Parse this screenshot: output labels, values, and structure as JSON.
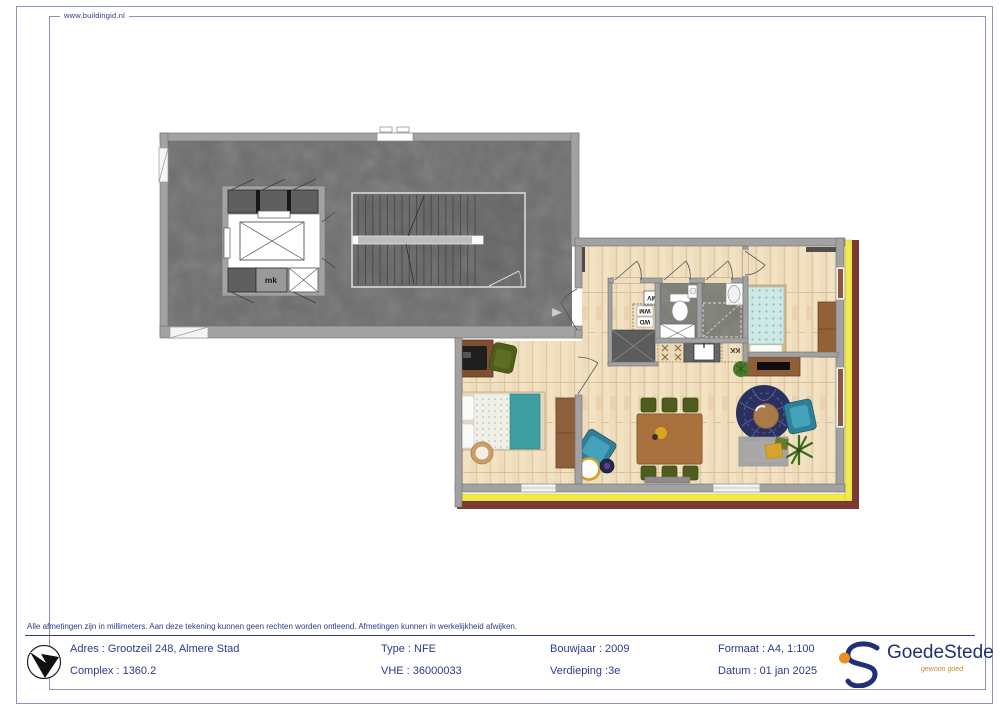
{
  "frame": {
    "website": "www.buildingid.nl"
  },
  "disclaimer": "Alle afmetingen zijn in millimeters. Aan deze tekening kunnen geen rechten worden ontleend. Afmetingen kunnen in werkelijkheid afwijken.",
  "titleblock": {
    "columns": [
      {
        "rows": [
          "Adres :  Grootzeil 248, Almere Stad",
          "Complex : 1360.2"
        ]
      },
      {
        "rows": [
          "Type : NFE",
          "VHE :  36000033"
        ]
      },
      {
        "rows": [
          "Bouwjaar : 2009",
          "Verdieping :3e"
        ]
      },
      {
        "rows": [
          "Formaat : A4, 1:100",
          "Datum :  01 jan 2025"
        ]
      }
    ],
    "logo": {
      "name": "GoedeStede",
      "tagline": "gewoon goed"
    }
  },
  "plan": {
    "labels": {
      "meter_cupboard": "mk",
      "mechanical_vent": "MV",
      "washer": "WM",
      "dryer": "WD",
      "kitchen_fridge": "KK"
    }
  },
  "colors": {
    "text_navy": "#2b3a8f",
    "frame_line": "#8d92bb",
    "corridor_floor": "#6d6d6d",
    "stair_floor": "#646464",
    "wall_gray": "#a2a2a2",
    "wood_floor": "#efddbc",
    "tile_floor": "#7b7b73",
    "balcony_yellow": "#f1e94a",
    "facade_maroon": "#7b3b32",
    "accent_teal": "#2e7f98",
    "chair_olive": "#4e5c20",
    "rug_navy": "#2a3160",
    "logo_navy": "#203076",
    "logo_orange": "#e89023"
  }
}
